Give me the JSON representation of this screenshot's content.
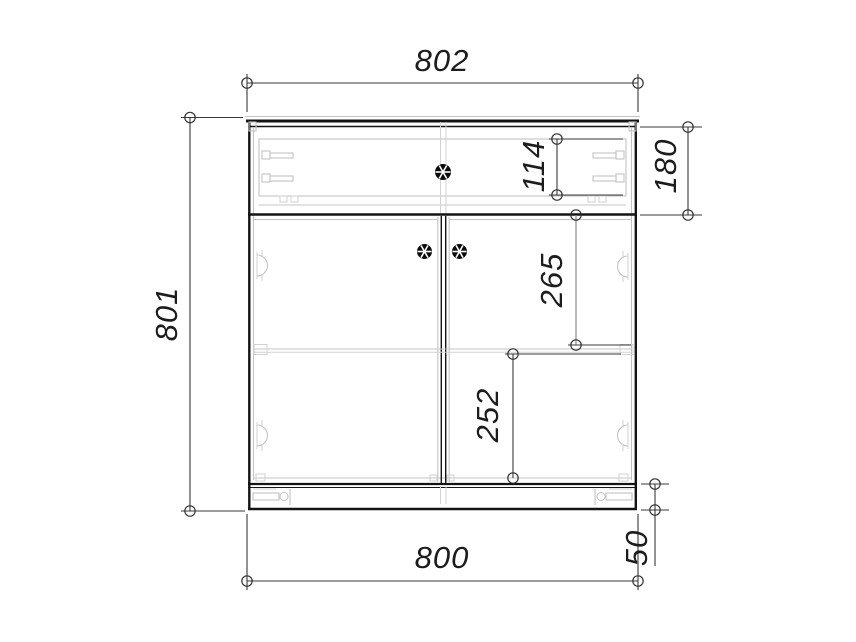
{
  "drawing": {
    "title": "cabinet-front-elevation",
    "dimensions": {
      "overall_width": "802",
      "overall_height": "801",
      "body_width": "800",
      "drawer_section_height": "180",
      "drawer_front_height": "114",
      "upper_door_offset": "265",
      "lower_door_offset": "252",
      "plinth_height": "50"
    },
    "colors": {
      "background": "#ffffff",
      "outline": "#141414",
      "detail_line": "#c4c4c4",
      "dimension_line": "#3a3a3a",
      "text": "#1c1c1c"
    }
  }
}
